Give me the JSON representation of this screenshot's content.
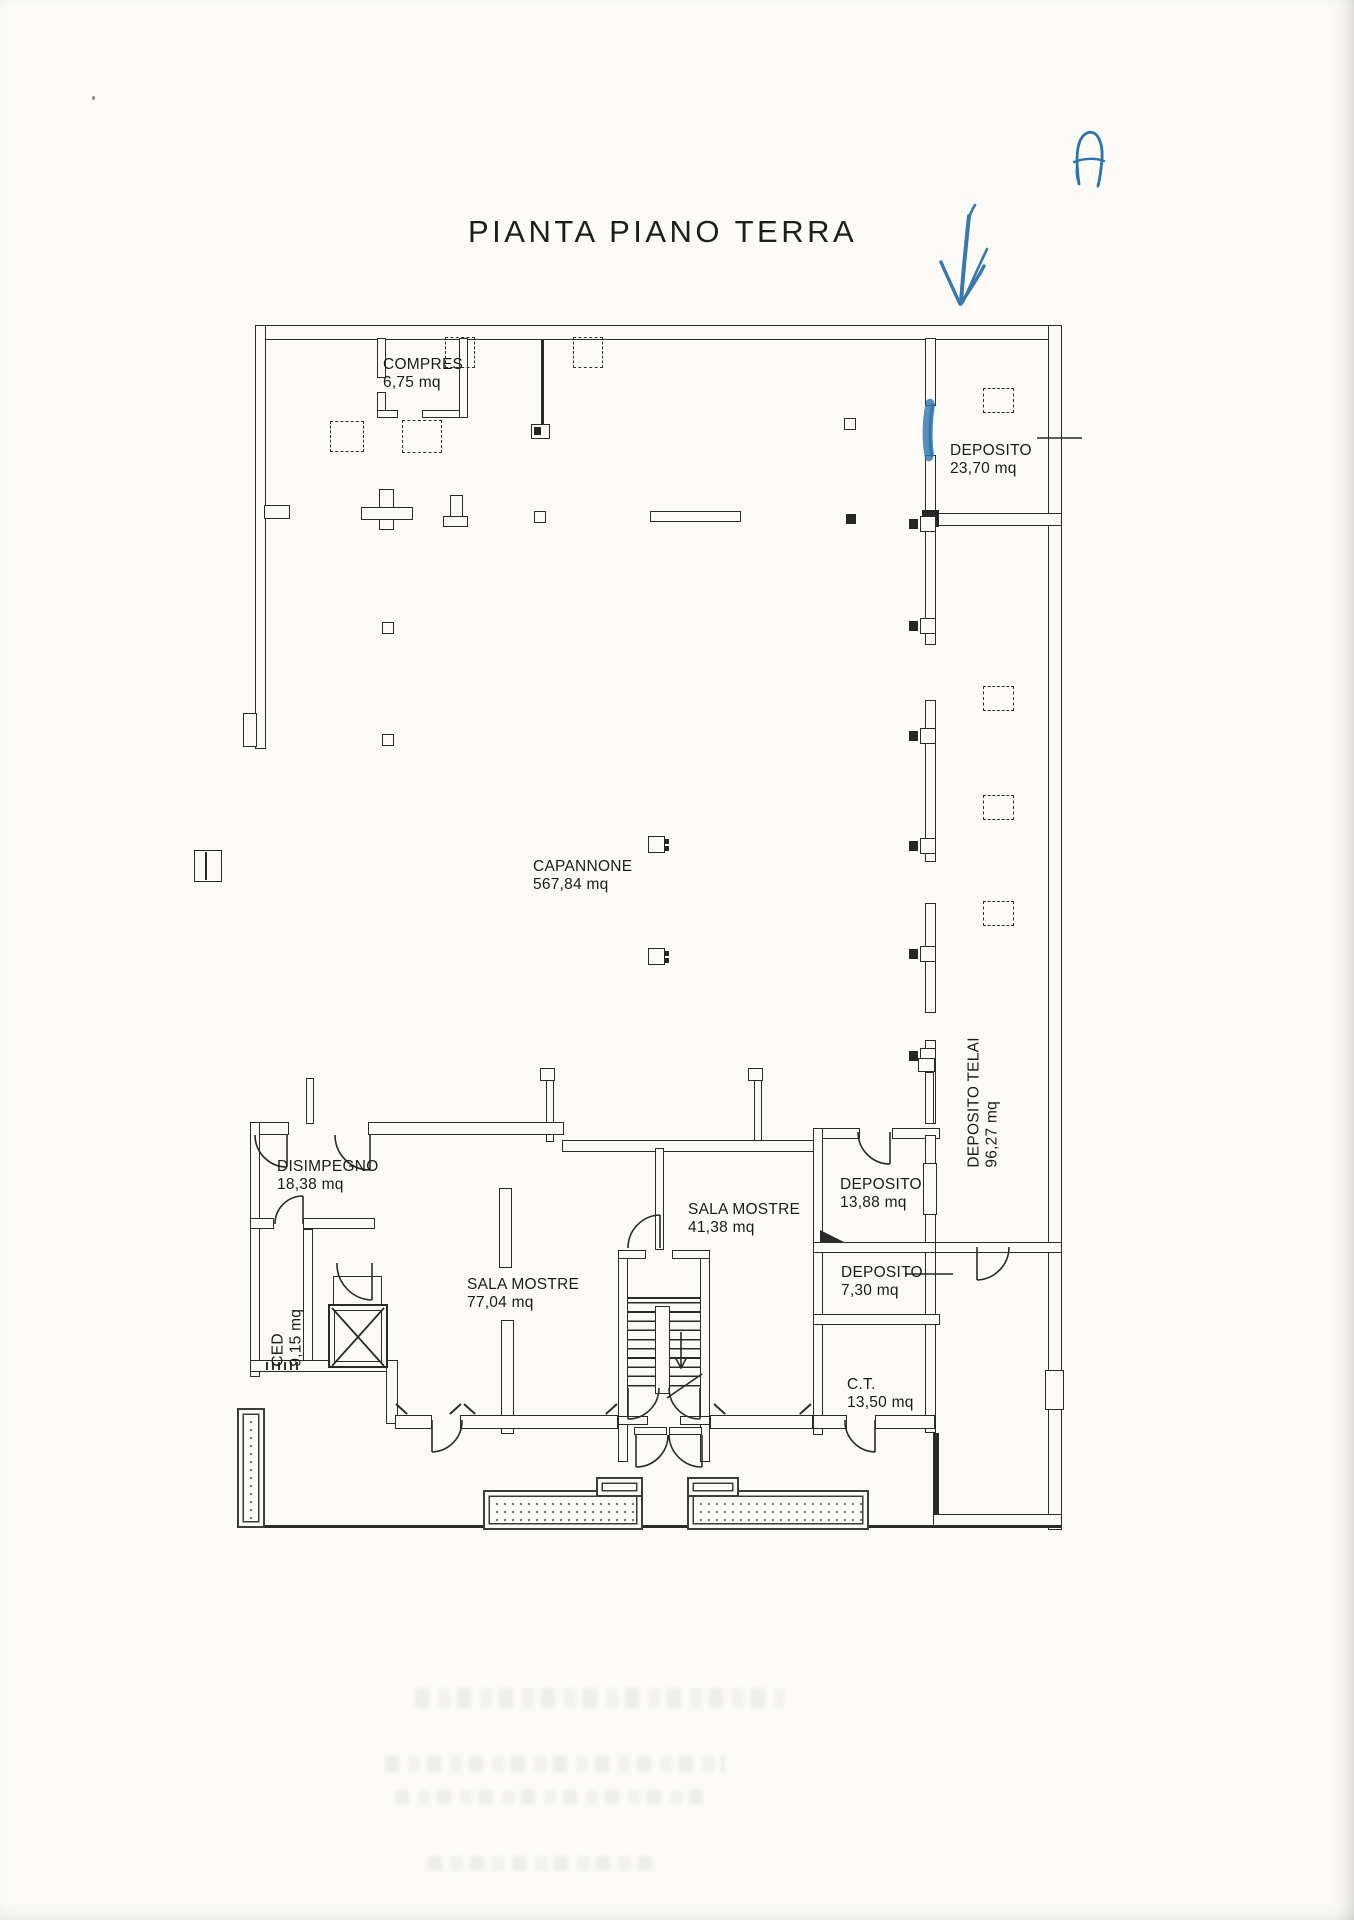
{
  "page": {
    "title": "PIANTA PIANO TERRA"
  },
  "annotations": {
    "letter": "A",
    "arrow": "hand-drawn blue arrow pointing down at top wall",
    "door_highlight": "blue highlighter stroke on door opening of DEPOSITO 23,70"
  },
  "rooms": [
    {
      "name": "COMPRES",
      "area": "6,75 mq"
    },
    {
      "name": "DEPOSITO",
      "area": "23,70 mq"
    },
    {
      "name": "CAPANNONE",
      "area": "567,84 mq"
    },
    {
      "name": "DEPOSITO TELAI",
      "area": "96,27 mq"
    },
    {
      "name": "DISIMPEGNO",
      "area": "18,38 mq"
    },
    {
      "name": "CED",
      "area": "9,15 mq"
    },
    {
      "name": "SALA MOSTRE",
      "area": "77,04 mq"
    },
    {
      "name": "SALA MOSTRE",
      "area": "41,38 mq"
    },
    {
      "name": "DEPOSITO",
      "area": "13,88 mq"
    },
    {
      "name": "DEPOSITO",
      "area": "7,30 mq"
    },
    {
      "name": "C.T.",
      "area": "13,50 mq"
    }
  ],
  "colors": {
    "ink": "#2a2a2a",
    "annotation_blue": "#2e72a8",
    "paper": "#fbfaf7"
  }
}
